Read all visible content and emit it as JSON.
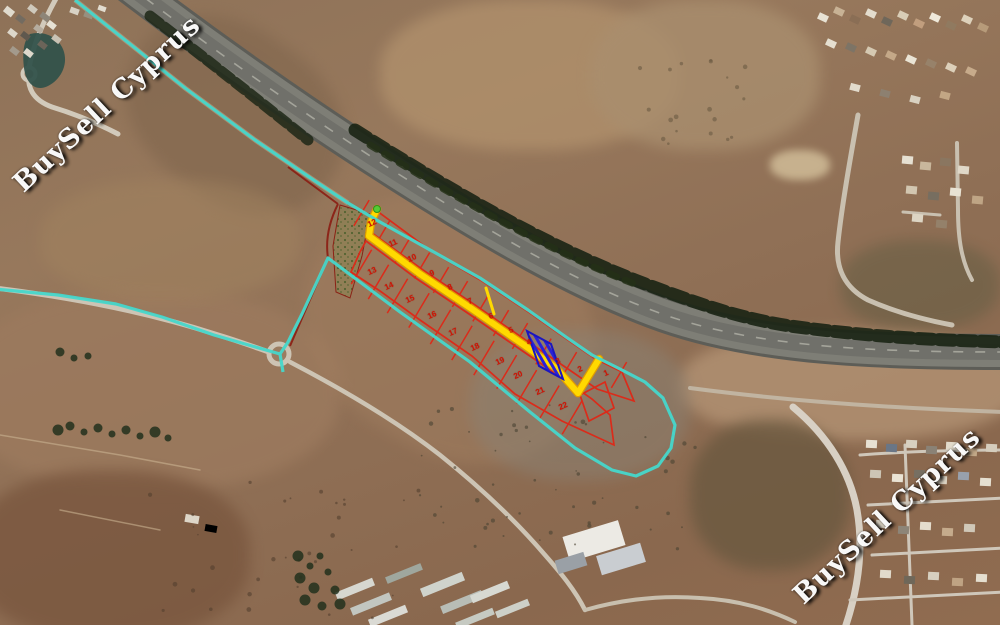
{
  "watermarks": {
    "topleft": "BuySell Cyprus",
    "bottomright": "BuySell Cyprus"
  },
  "colors": {
    "boundary_cyan": "#46d7cb",
    "plot_red": "#db2b1a",
    "number_red": "#cf1505",
    "road_yellow": "#ffd900",
    "road_casing": "#e09c00",
    "selected_blue": "#2a22d8",
    "selected_border": "#1b16c0",
    "parcel_maroon": "#8b1d12",
    "entrance_green": "#54cc35"
  },
  "plots": {
    "row_top": [
      {
        "num": "12",
        "x": 372,
        "y": 223
      },
      {
        "num": "11",
        "x": 393,
        "y": 243
      },
      {
        "num": "10",
        "x": 412,
        "y": 258
      },
      {
        "num": "9",
        "x": 432,
        "y": 273
      },
      {
        "num": "8",
        "x": 450,
        "y": 287
      },
      {
        "num": "7",
        "x": 470,
        "y": 301
      },
      {
        "num": "6",
        "x": 491,
        "y": 316
      },
      {
        "num": "5",
        "x": 511,
        "y": 330
      },
      {
        "num": "4",
        "x": 529,
        "y": 342
      },
      {
        "num": "3",
        "x": 558,
        "y": 361
      },
      {
        "num": "2",
        "x": 580,
        "y": 369
      },
      {
        "num": "1",
        "x": 606,
        "y": 373
      }
    ],
    "row_left": [
      {
        "num": "13",
        "x": 372,
        "y": 271
      },
      {
        "num": "14",
        "x": 389,
        "y": 286
      },
      {
        "num": "15",
        "x": 410,
        "y": 299
      },
      {
        "num": "16",
        "x": 432,
        "y": 315
      },
      {
        "num": "17",
        "x": 453,
        "y": 332
      },
      {
        "num": "18",
        "x": 475,
        "y": 347
      }
    ],
    "row_bottom": [
      {
        "num": "19",
        "x": 500,
        "y": 361
      },
      {
        "num": "20",
        "x": 518,
        "y": 375
      },
      {
        "num": "21",
        "x": 540,
        "y": 391
      },
      {
        "num": "22",
        "x": 563,
        "y": 406
      }
    ]
  }
}
